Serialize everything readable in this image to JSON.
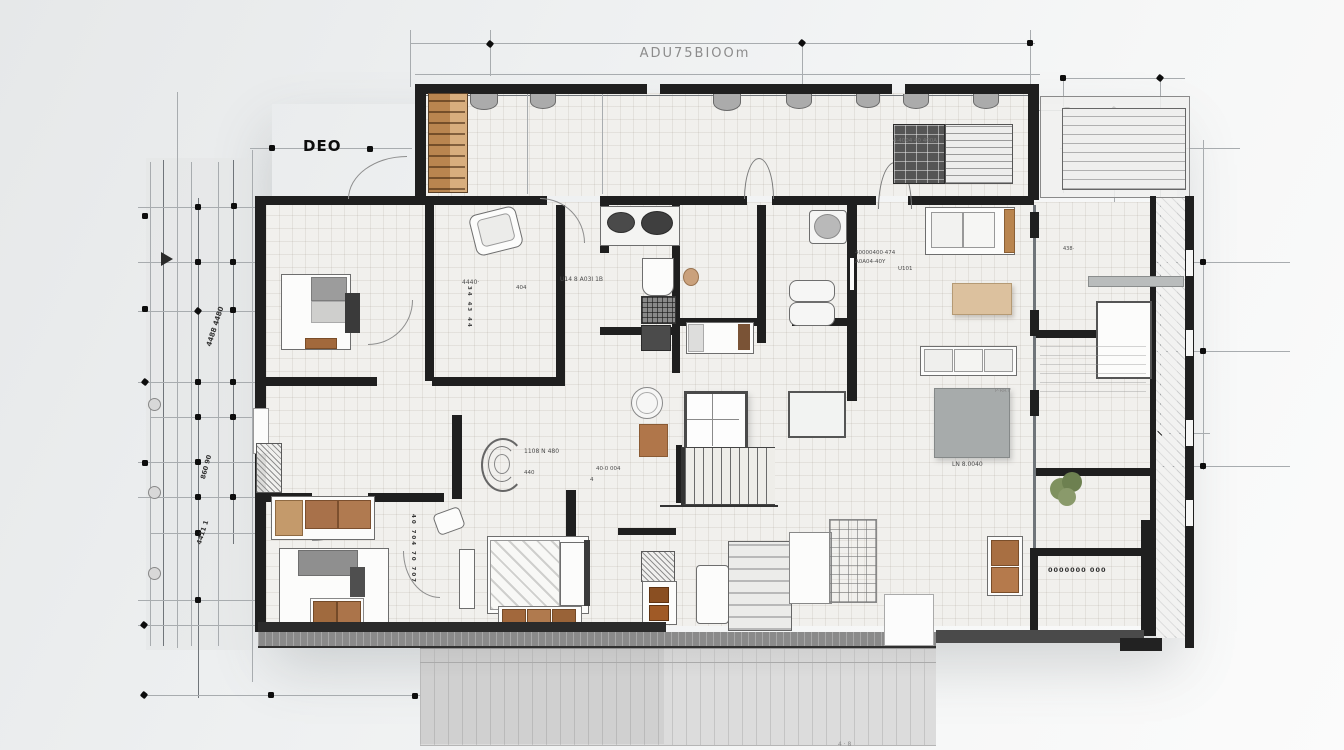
{
  "drawing": {
    "type": "architectural floor plan, sketch-style render",
    "title": "ADU75BIOOm",
    "axis_label": "DEO"
  },
  "labels": {
    "title": "ADU75BIOOm",
    "deo": "DEO",
    "dim_left_1": "4488 4480",
    "dim_left_2": "860 90",
    "dim_left_3": "4411 1",
    "n4440": "4440·",
    "nU14": "U14 8 A03I 1B",
    "n404": "404",
    "cl1": "40000400·474",
    "cl2": "A0A04-40Y",
    "cl3": "U101",
    "ntop": "4·4004 40 400A",
    "n1108": "1108 N 480",
    "n440": "440",
    "n400": "40·0 004",
    "n4": "4",
    "nstair": "LN 8.0040",
    "npr": "P·RR F",
    "nroom": "0000000 000",
    "ntiny": "438·",
    "col1": "40 704 70 707",
    "col2": "34 43 44",
    "nbottom": "4 · 8"
  },
  "colors": {
    "wall": "#1f1f1f",
    "wood": "#b9854f",
    "wood_light": "#d8ae7e",
    "tan_table": "#dcc19e",
    "brown_cushion": "#a06a3e",
    "burner_brown": "#8a4f22",
    "gray_furniture": "#9b9b9b",
    "plant_green": "#7f915f",
    "floor": "#f1f0ed",
    "deck": "#dcdcdc",
    "background": "#eef0f1"
  }
}
